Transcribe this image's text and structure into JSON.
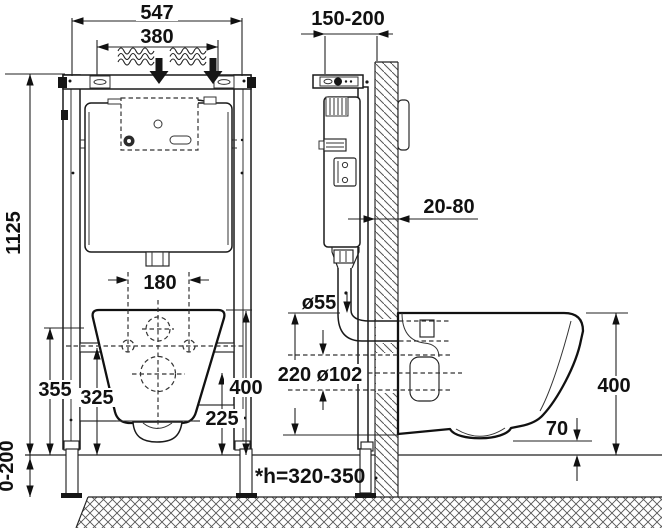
{
  "diagram": {
    "front_view": {
      "dim_outer_width": "547",
      "dim_inlet_span": "380",
      "dim_total_height": "1125",
      "dim_bolt_span": "180",
      "dim_rail_upper_height": "355",
      "dim_rail_lower_height": "325",
      "dim_outlet_center_height": "225",
      "dim_bowl_top_height": "400",
      "dim_feet_range": "0-200"
    },
    "side_view": {
      "dim_depth_range": "150-200",
      "dim_cladding_range": "20-80",
      "dim_flush_pipe_dia": "ø55",
      "dim_outlet_spacing_dia": "220 ø102",
      "dim_bowl_height": "400",
      "dim_bowl_clearance": "70",
      "note_seat_height": "*h=320-350"
    },
    "colors": {
      "line": "#111111",
      "background": "#ffffff"
    }
  }
}
